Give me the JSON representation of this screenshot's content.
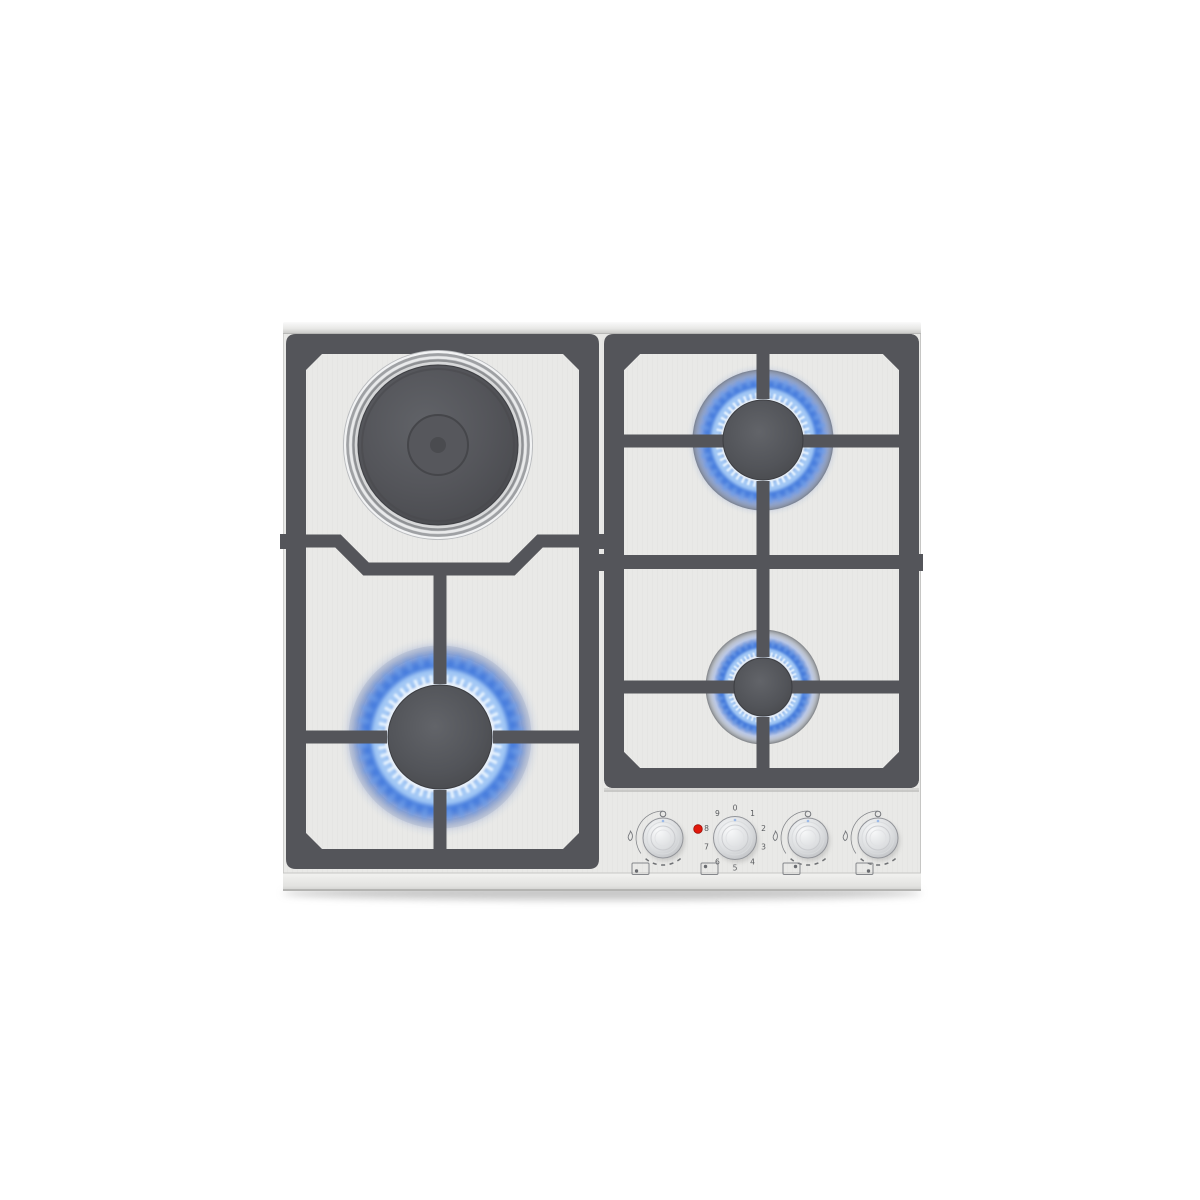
{
  "appliance": {
    "label": "Built-in 4-zone stainless-steel cooktop: one electric hotplate (back-left, off) and three lit gas burners",
    "zones": [
      {
        "id": "back-left",
        "kind": "electric-hotplate",
        "size": "large",
        "state": "off"
      },
      {
        "id": "front-left",
        "kind": "gas-burner",
        "size": "large",
        "state": "lit"
      },
      {
        "id": "back-right",
        "kind": "gas-burner",
        "size": "medium",
        "state": "lit"
      },
      {
        "id": "front-right",
        "kind": "gas-burner",
        "size": "small",
        "state": "lit"
      }
    ],
    "hotplate_dial": {
      "numbers": [
        "0",
        "1",
        "2",
        "3",
        "4",
        "5",
        "6",
        "7",
        "8",
        "9"
      ]
    },
    "indicator": {
      "state": "on",
      "color": "#e2180c"
    },
    "knobs": [
      {
        "id": "knob-front-left-burner",
        "type": "gas",
        "marks": [
          "circle-top",
          "flame-left",
          "dashed-arc"
        ],
        "position_icon": "dot-bottom-left"
      },
      {
        "id": "knob-hotplate",
        "type": "electric",
        "marks": [
          "numbers-0-9"
        ],
        "position_icon": "dot-top-left"
      },
      {
        "id": "knob-back-right-burner",
        "type": "gas",
        "marks": [
          "circle-top",
          "flame-left",
          "dashed-arc"
        ],
        "position_icon": "dot-top-right"
      },
      {
        "id": "knob-front-right-burner",
        "type": "gas",
        "marks": [
          "circle-top",
          "flame-left",
          "dashed-arc"
        ],
        "position_icon": "dot-bottom-right"
      }
    ],
    "colors": {
      "surface": "#eaeae8",
      "grate": "#54555a",
      "flame_deep": "#2b57bd",
      "flame_bright": "#a9cdf7",
      "steel": "#c9cbcd",
      "background": "#ffffff"
    }
  }
}
